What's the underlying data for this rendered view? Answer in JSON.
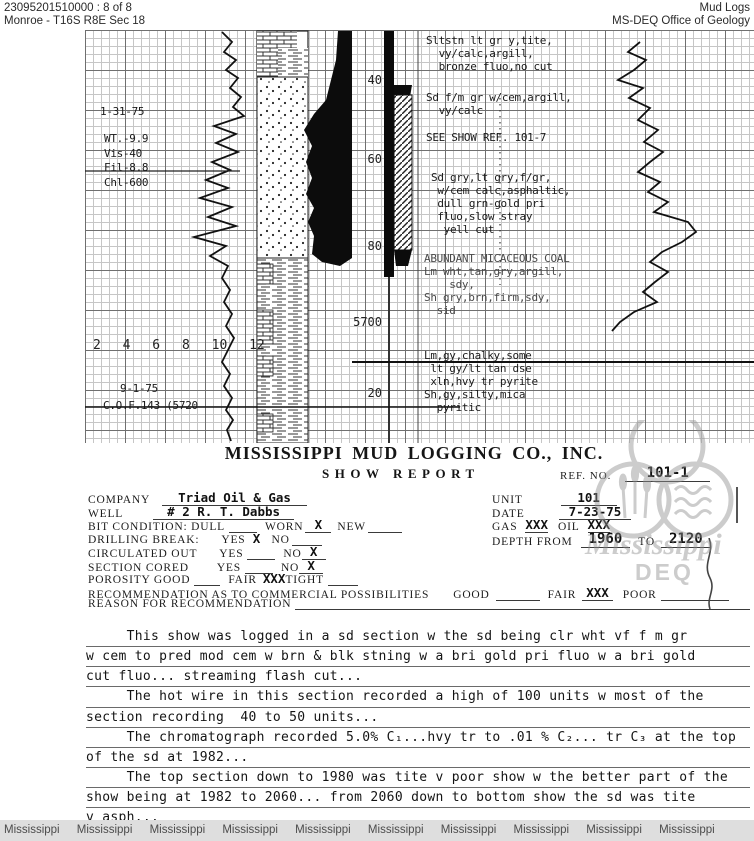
{
  "header": {
    "doc_number": "23095201510000 : 8 of 8",
    "location": "Monroe - T16S R8E Sec 18",
    "collection": "Mud Logs",
    "agency": "MS-DEQ Office of Geology"
  },
  "log": {
    "mud_check_date": "1-31-75",
    "mud_properties": "WT.-9.9\nVis-40\nFil-8.8\nChl-600",
    "scale_numbers": "2 4 6 8 10 12",
    "bottom_date": "9-1-75",
    "bottom_note": "C.O.F.143 (5720",
    "depth_labels": [
      "40",
      "60",
      "80",
      "5700",
      "20"
    ],
    "annotations": [
      "Sltstn lt gr y,tite,\n  vy/calc,argill,\n  bronze fluo,no cut",
      "Sd f/m gr w/cem,argill,\n  vy/calc",
      "SEE SHOW REF. 101-7",
      "Sd gry,lt gry,f/gr,\n w/cem calc,asphaltic,\n dull grn-gold pri\n fluo,slow stray\n  yell cut",
      "ABUNDANT MICACEOUS COAL\nLm wht,tan,gry,argill,\n    sdy,\nSh gry,brn,firm,sdy,\n  sid",
      "Lm,gy,chalky,some\n lt gy/lt tan dse\n xln,hvy tr pyrite\nSh,gy,silty,mica\n  pyritic"
    ]
  },
  "report": {
    "company_title": "MISSISSIPPI MUD LOGGING CO., INC.",
    "report_title": "SHOW REPORT",
    "ref_label": "REF. NO.",
    "ref_value": "101-1"
  },
  "form": {
    "company_label": "COMPANY",
    "company_value": "Triad Oil & Gas",
    "well_label": "WELL",
    "well_value": "# 2 R. T. Dabbs",
    "bit_label": "BIT CONDITION: DULL",
    "worn_label": "WORN",
    "worn_value": "X",
    "new_label": "NEW",
    "drilling_label": "DRILLING BREAK:",
    "yes_label": "YES",
    "no_label": "NO",
    "drilling_yes": "X",
    "circulated_label": "CIRCULATED OUT",
    "circulated_no": "X",
    "cored_label": "SECTION CORED",
    "cored_no": "X",
    "porosity_label": "POROSITY GOOD",
    "fair_label": "FAIR",
    "porosity_fair": "XXX",
    "tight_label": "TIGHT",
    "recommendation_label": "RECOMMENDATION AS TO COMMERCIAL POSSIBILITIES",
    "good_label": "GOOD",
    "rec_fair_value": "XXX",
    "poor_label": "POOR",
    "reason_label": "REASON FOR RECOMMENDATION",
    "unit_label": "UNIT",
    "unit_value": "101",
    "date_label": "DATE",
    "date_value": "7-23-75",
    "gas_label": "GAS",
    "gas_value": "XXX",
    "oil_label": "OIL",
    "oil_value": "XXX",
    "depth_from_label": "DEPTH FROM",
    "depth_from_value": "1960",
    "to_label": "TO",
    "depth_to_value": "2120"
  },
  "report_body": [
    "     This show was logged in a sd section w the sd being clr wht vf f m gr",
    "w cem to pred mod cem w brn & blk stning w a bri gold pri fluo w a bri gold",
    "cut fluo... streaming flash cut...",
    "     The hot wire in this section recorded a high of 100 units w most of the",
    "section recording  40 to 50 units...",
    "     The chromatograph recorded 5.0% C₁...hvy tr to .01 % C₂... tr C₃ at the top",
    "of the sd at 1982...",
    "     The top section down to 1980 was tite v poor show w the better part of the",
    "show being at 1982 to 2060... from 2060 down to bottom show the sd was tite",
    "v asph..."
  ],
  "watermark": {
    "name": "Mississippi",
    "dept": "DEQ"
  },
  "footer": {
    "text": "Mississippi Mississippi Mississippi Mississippi Mississippi Mississippi Mississippi Mississippi Mississippi Mississippi"
  }
}
